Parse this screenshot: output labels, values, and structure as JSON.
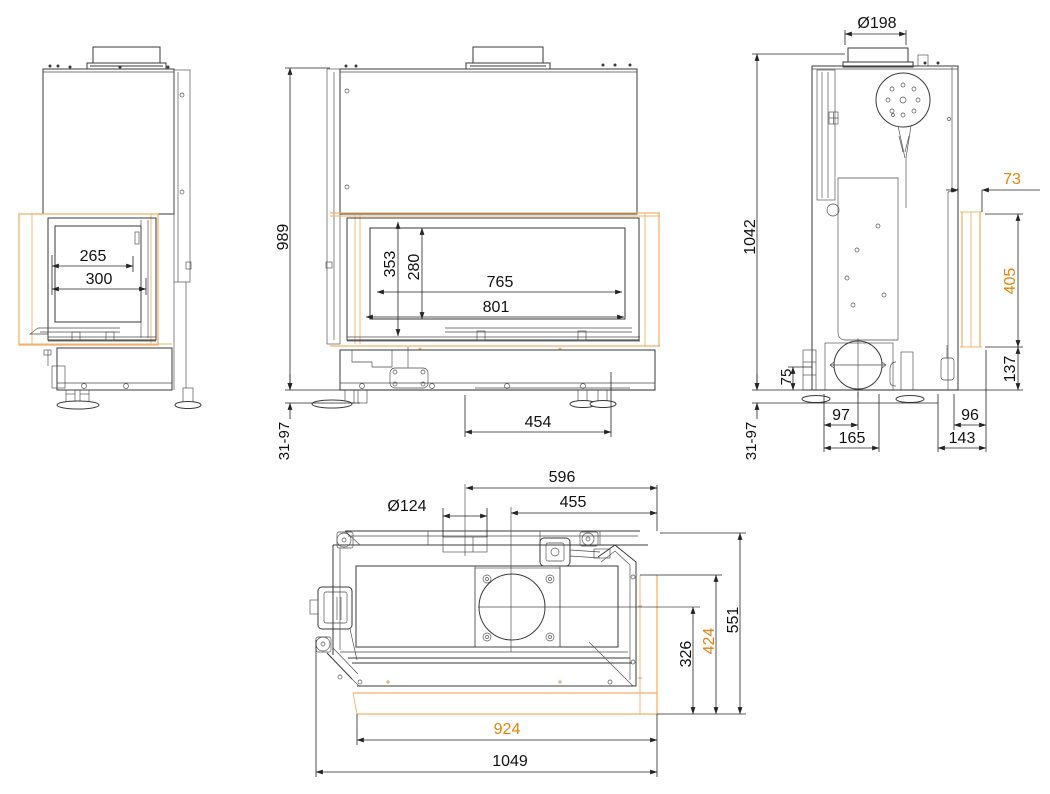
{
  "drawing_type": "fireplace-insert-technical-drawing",
  "colors": {
    "line": "#3a3a3a",
    "dimension_text": "#111111",
    "accent_orange_text": "#e8820a",
    "glass_outline_orange": "#f0b36e",
    "background": "#ffffff"
  },
  "views": {
    "side_glass": {
      "name": "side-view-with-glass-door",
      "dims": {
        "glass_width": "265",
        "frame_width": "300"
      }
    },
    "front": {
      "name": "front-view",
      "dims": {
        "height": "989",
        "glass_frame_height": "353",
        "glass_inner_height": "280",
        "glass_width": "765",
        "frame_width": "801",
        "base_offset": "454",
        "feet_range": "31-97"
      }
    },
    "side_service": {
      "name": "side-view-with-mechanism",
      "dims": {
        "flue_diameter": "Ø198",
        "height": "1042",
        "glass_offset": "73",
        "glass_height": "405",
        "plinth_height": "137",
        "inlet_height": "75",
        "inlet_offset": "97",
        "inlet_offset_outer": "165",
        "rear_offset": "96",
        "rear_offset_outer": "143",
        "feet_range": "31-97"
      }
    },
    "top": {
      "name": "top-plan-view",
      "dims": {
        "flue_edge_offset": "596",
        "flue_center_offset": "455",
        "air_inlet_diameter": "Ø124",
        "depth_to_center": "326",
        "glass_depth": "424",
        "total_depth": "551",
        "glass_width": "924",
        "total_width": "1049"
      }
    }
  }
}
